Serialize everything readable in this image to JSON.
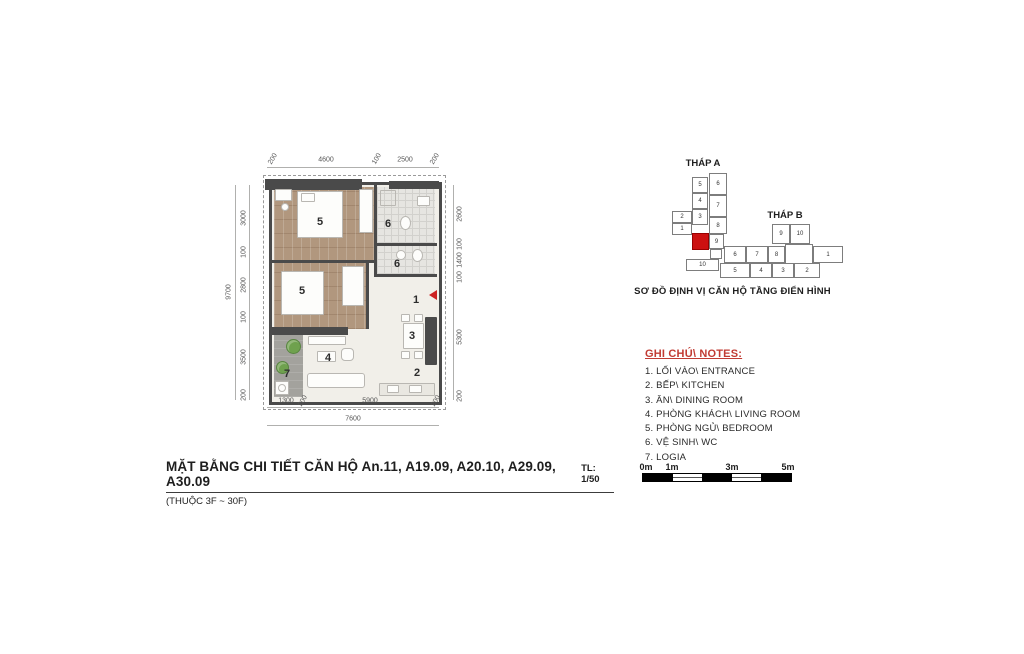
{
  "title": {
    "main": "MẶT BẰNG CHI TIẾT CĂN HỘ An.11, A19.09, A20.10, A29.09, A30.09",
    "scale": "TL: 1/50",
    "sub": "(THUỘC 3F ~ 30F)"
  },
  "floor_plan": {
    "room_numbers": {
      "entrance": "1",
      "kitchen": "2",
      "dining": "3",
      "living": "4",
      "bedroom_1": "5",
      "bedroom_2": "5",
      "wc_1": "6",
      "wc_2": "6",
      "logia": "7"
    },
    "dimensions": {
      "top": [
        "200",
        "4600",
        "100",
        "2500",
        "200"
      ],
      "left": [
        "3000",
        "100",
        "2800",
        "100",
        "3500",
        "200"
      ],
      "left_total": "9700",
      "right": [
        "2600",
        "100",
        "1400",
        "100",
        "5300",
        "200"
      ],
      "bottom": [
        "1300",
        "200",
        "5900",
        "200"
      ],
      "bottom_total": "7600"
    }
  },
  "site_map": {
    "caption": "SƠ ĐỒ ĐỊNH VỊ CĂN HỘ TẦNG ĐIỂN HÌNH",
    "highlight_color": "#cc1111",
    "tower_a": {
      "label": "THÁP A",
      "units": [
        {
          "n": "5",
          "x": 22,
          "y": 6,
          "w": 16,
          "h": 16
        },
        {
          "n": "4",
          "x": 22,
          "y": 22,
          "w": 16,
          "h": 16
        },
        {
          "n": "3",
          "x": 22,
          "y": 38,
          "w": 16,
          "h": 16
        },
        {
          "n": "6",
          "x": 39,
          "y": 2,
          "w": 18,
          "h": 22
        },
        {
          "n": "7",
          "x": 39,
          "y": 24,
          "w": 18,
          "h": 22
        },
        {
          "n": "8",
          "x": 39,
          "y": 46,
          "w": 18,
          "h": 17
        },
        {
          "n": "9",
          "x": 39,
          "y": 63,
          "w": 15,
          "h": 15
        },
        {
          "n": "2",
          "x": 2,
          "y": 40,
          "w": 20,
          "h": 12
        },
        {
          "n": "1",
          "x": 2,
          "y": 52,
          "w": 20,
          "h": 12
        },
        {
          "n": "",
          "x": 22,
          "y": 62,
          "w": 17,
          "h": 17,
          "red": true
        },
        {
          "n": "",
          "x": 40,
          "y": 78,
          "w": 12,
          "h": 10
        },
        {
          "n": "10",
          "x": 16,
          "y": 88,
          "w": 33,
          "h": 12
        }
      ]
    },
    "tower_b": {
      "label": "THÁP B",
      "units": [
        {
          "n": "9",
          "x": 52,
          "y": 0,
          "w": 18,
          "h": 20
        },
        {
          "n": "10",
          "x": 70,
          "y": 0,
          "w": 20,
          "h": 20
        },
        {
          "n": "6",
          "x": 4,
          "y": 22,
          "w": 22,
          "h": 17
        },
        {
          "n": "7",
          "x": 26,
          "y": 22,
          "w": 22,
          "h": 17
        },
        {
          "n": "8",
          "x": 48,
          "y": 22,
          "w": 17,
          "h": 17
        },
        {
          "n": "",
          "x": 65,
          "y": 20,
          "w": 28,
          "h": 21
        },
        {
          "n": "1",
          "x": 93,
          "y": 22,
          "w": 30,
          "h": 17
        },
        {
          "n": "5",
          "x": 0,
          "y": 39,
          "w": 30,
          "h": 15
        },
        {
          "n": "4",
          "x": 30,
          "y": 39,
          "w": 22,
          "h": 15
        },
        {
          "n": "3",
          "x": 52,
          "y": 39,
          "w": 22,
          "h": 15
        },
        {
          "n": "2",
          "x": 74,
          "y": 39,
          "w": 26,
          "h": 15
        }
      ]
    }
  },
  "notes": {
    "heading": "GHI CHÚ\\ NOTES:",
    "items": [
      "1. LỐI VÀO\\ ENTRANCE",
      "2. BẾP\\ KITCHEN",
      "3. ĂN\\ DINING ROOM",
      "4. PHÒNG KHÁCH\\ LIVING ROOM",
      "5. PHÒNG NGỦ\\ BEDROOM",
      "6. VỆ SINH\\ WC",
      "7. LOGIA"
    ]
  },
  "scale_bar": {
    "labels": [
      "0m",
      "1m",
      "3m",
      "5m"
    ]
  }
}
